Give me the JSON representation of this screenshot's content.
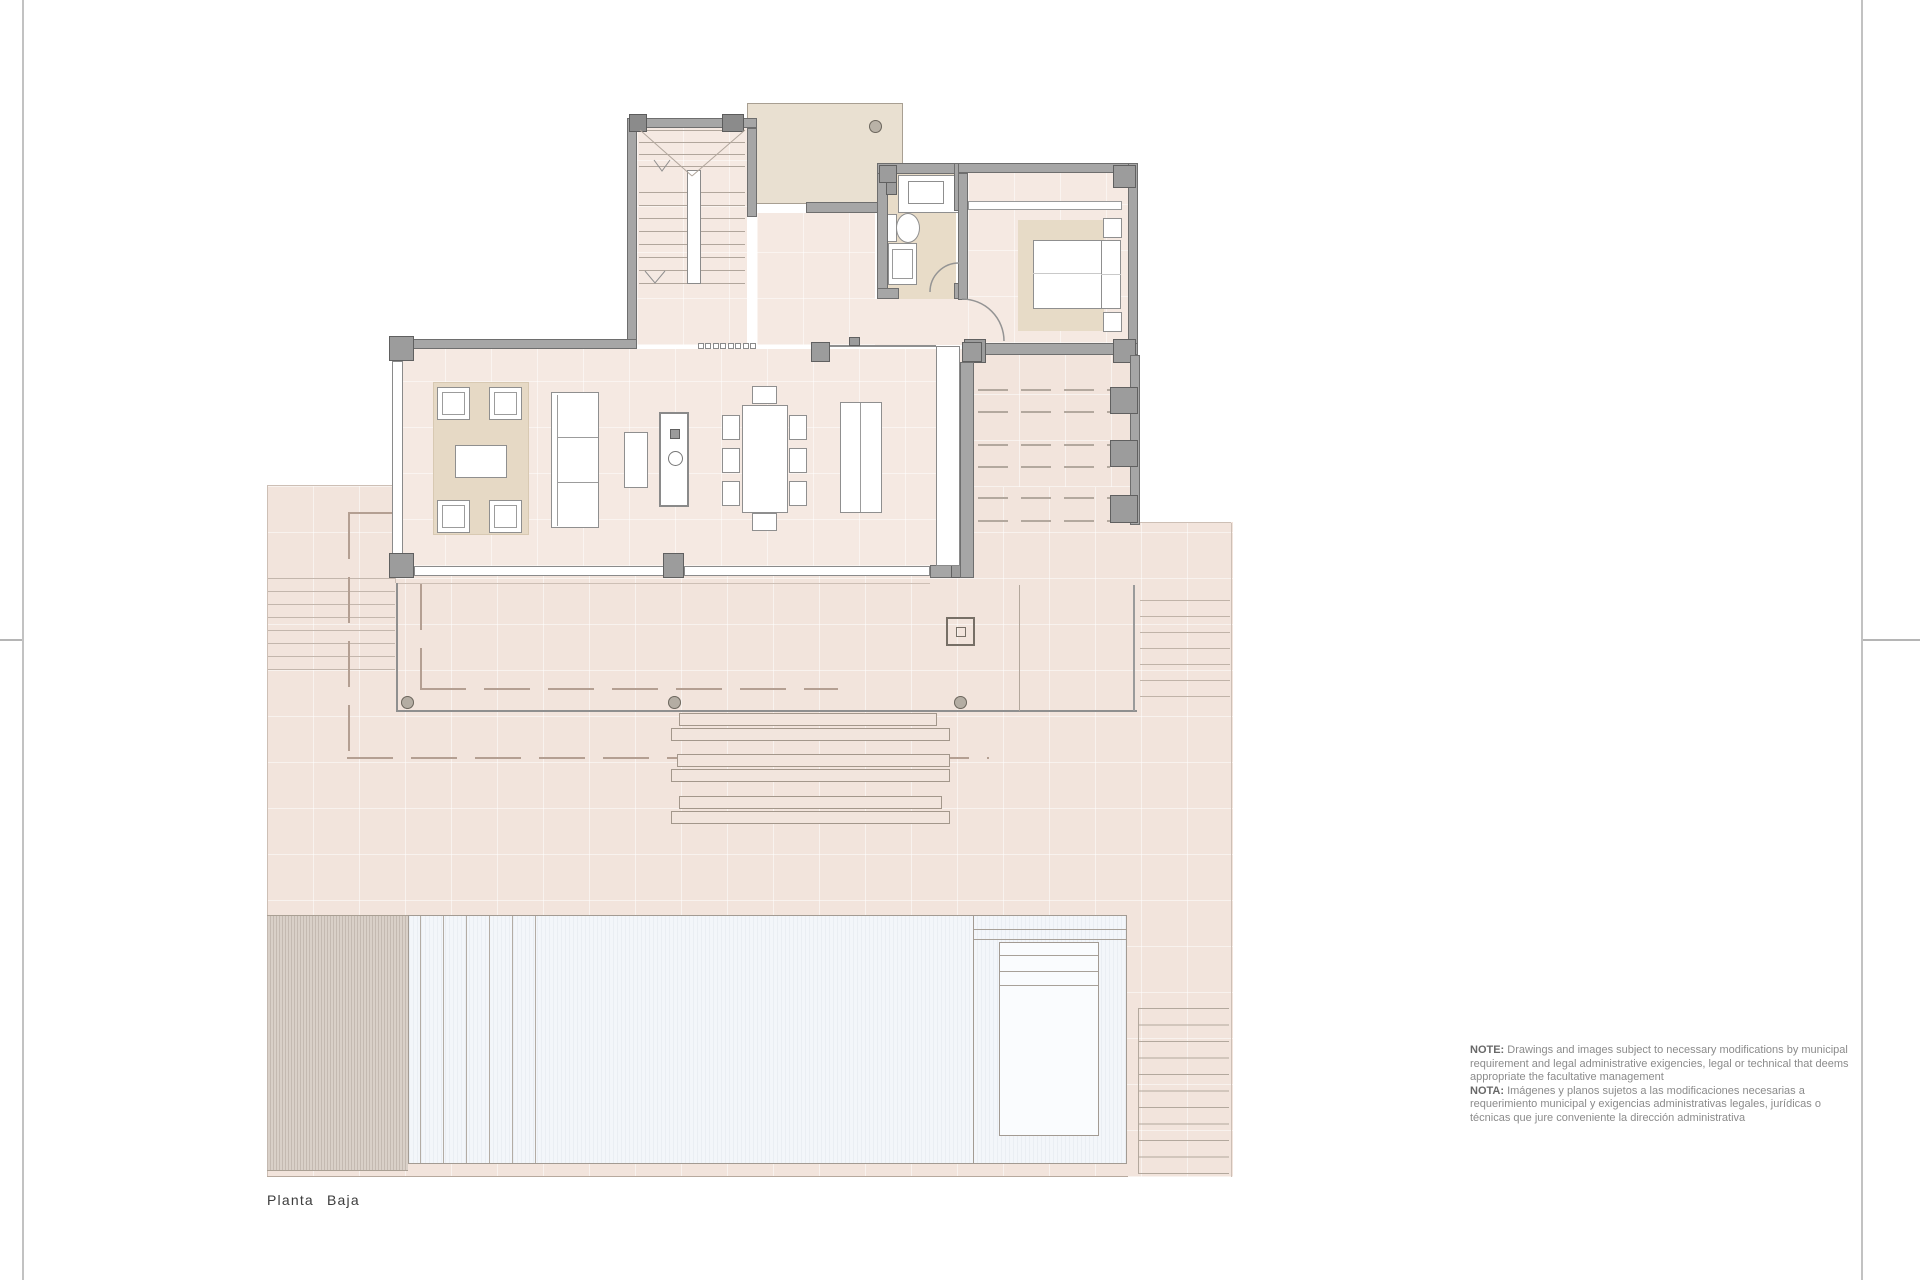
{
  "title_label": "Planta Baja",
  "note": {
    "en_label": "NOTE:",
    "en_text": " Drawings and images subject to necessary modifications by municipal requirement and legal administrative exigencies, legal or technical that deems appropriate the facultative management",
    "es_label": "NOTA:",
    "es_text": " Imágenes y planos sujetos a las modificaciones necesarias a requerimiento municipal y exigencias administrativas legales, jurídicas o técnicas que jure conveniente la dirección administrativa"
  },
  "colors": {
    "paper": "#ffffff",
    "terrace": "#f2e4dc",
    "interior_floor": "#f5e9e2",
    "beige_rug": "#e7dbc7",
    "patio_roof": "#e9e0d1",
    "wall": "#a6a6a6",
    "wall_outline": "#6e6e6e",
    "pool_water": "#f3f6fa",
    "wood_deck": "#d9d0c8",
    "plan_line": "#cdbfb5",
    "dash_line": "#b49f92",
    "label_text": "#3c3c3c",
    "note_text": "#8b8b8b"
  }
}
